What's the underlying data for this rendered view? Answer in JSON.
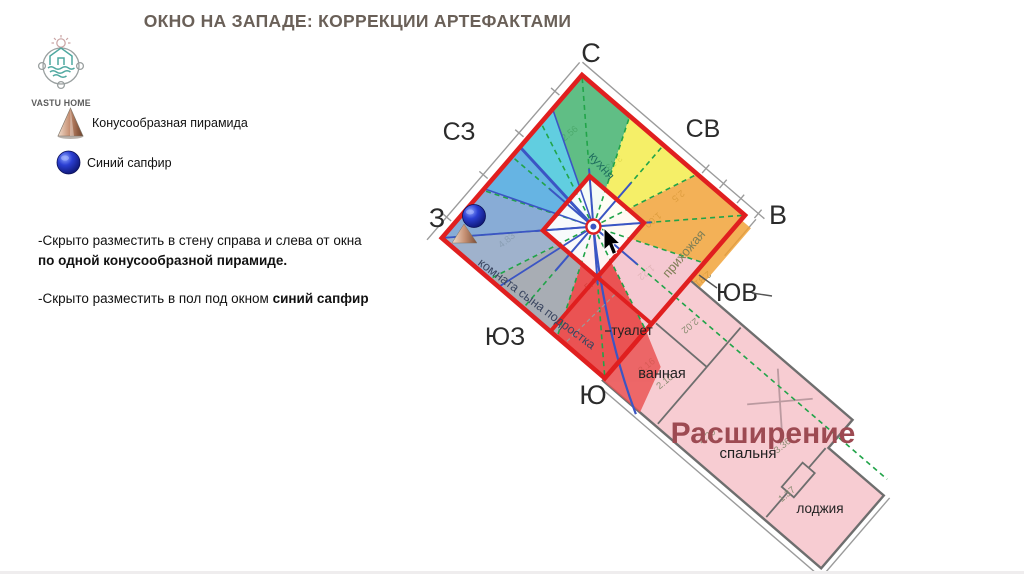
{
  "slide": {
    "title": "ОКНО НА ЗАПАДЕ: КОРРЕКЦИИ АРТЕФАКТАМИ",
    "brand": "VASTU HOME",
    "legend": [
      {
        "icon": "cone-pyramid-icon",
        "label": "Конусообразная пирамида"
      },
      {
        "icon": "sapphire-icon",
        "label": "Синий сапфир"
      }
    ],
    "instructions": [
      {
        "text": "-Скрыто разместить в стену справа и слева от окна ",
        "bold": "по одной конусообразной пирамиде."
      },
      {
        "text": "-Скрыто разместить в пол под окном ",
        "bold": "синий сапфир"
      }
    ]
  },
  "plan": {
    "compass": {
      "n": "С",
      "ne": "СВ",
      "e": "В",
      "se": "ЮВ",
      "s": "Ю",
      "sw": "ЮЗ",
      "w": "З",
      "nw": "СЗ"
    },
    "rooms": {
      "kitchen": "кухня",
      "hallway": "прихожая",
      "sons_room": "комната сына подростка",
      "toilet": "туалет",
      "bathroom": "ванная",
      "bedroom": "спальня",
      "loggia": "лоджия"
    },
    "extension_label": "Расширение",
    "dimensions": [
      "2.56",
      "3.73",
      "2.5",
      "1.00",
      "1.22",
      "2.81",
      "4.83",
      "5.4",
      "2.02",
      "3.16",
      "2.10",
      "4.29",
      "3.36",
      "1.37"
    ],
    "colors": {
      "border_red": "#e01f1f",
      "sector_north_green": "#3eb06b",
      "sector_nnw_turquoise": "#3fc4da",
      "sector_nw_sky": "#45a4dd",
      "sector_w_steel": "#6e9ace",
      "sector_wsw_slate": "#8aa2c2",
      "sector_sw_gray": "#969ca4",
      "sector_s_red": "#e62e2e",
      "sector_se_pink": "#f4bdc8",
      "sector_e_orange": "#f1a133",
      "sector_ne_yellow": "#f4ec48",
      "extension_pink": "#f7ccd2",
      "compass_ray_blue": "#3b55c4",
      "compass_ray_green": "#21a449",
      "extension_text": "#9d4a52",
      "title_text": "#6a6058"
    }
  }
}
